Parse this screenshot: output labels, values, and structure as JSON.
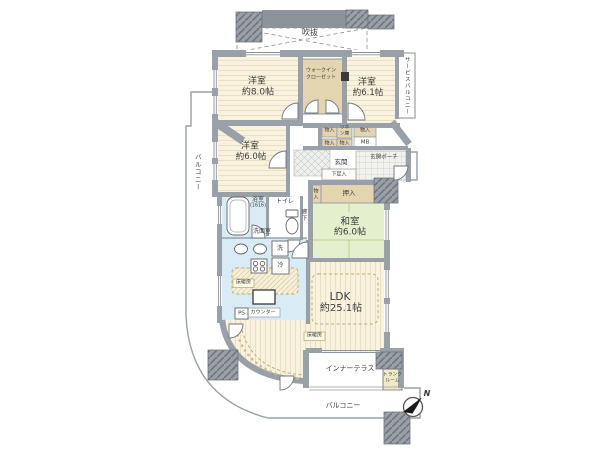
{
  "plan": {
    "atrium": "吹抜",
    "bedroom_label": "洋室",
    "bedroom1_size": "約8.0帖",
    "bedroom2_size": "約6.1帖",
    "bedroom3_size": "約6.0帖",
    "wic_line1": "ウォークイン",
    "wic_line2": "クローゼット",
    "service_balcony": "サービスバルコニー",
    "storage": "物入",
    "linen_line1": "リネ",
    "linen_line2": "ン庫",
    "meter_box": "MB",
    "entrance": "玄関",
    "entrance_porch": "玄関ポーチ",
    "shoe_cabinet": "下足入",
    "oshiire": "押入",
    "japanese_room": "和室",
    "japanese_room_size": "約6.0帖",
    "bathroom": "浴室",
    "bathroom_size": "(1616)",
    "toilet": "トイレ",
    "hallway": "廊下",
    "washroom": "洗面室",
    "washer": "洗",
    "fridge": "冷",
    "floor_heating": "床暖房",
    "counter": "カウンター",
    "pipe_space": "PS",
    "ldk": "LDK",
    "ldk_size": "約25.1帖",
    "inner_terrace": "インナーテラス",
    "trunk_line1": "トランク",
    "trunk_line2": "ルーム",
    "balcony": "バルコニー",
    "north": "N"
  },
  "colors": {
    "wall": "#9aa0a8",
    "wall_dark": "#8d939b",
    "wood": "#f9f2de",
    "wood_stripe": "#e9dfc2",
    "tatami": "#e3efcd",
    "tatami_line": "#b9cf96",
    "wet": "#d9ebf4",
    "closet": "#e3d5af",
    "trunk": "#f0e9c8",
    "heat_line": "#b9a96a",
    "line": "#777777"
  }
}
